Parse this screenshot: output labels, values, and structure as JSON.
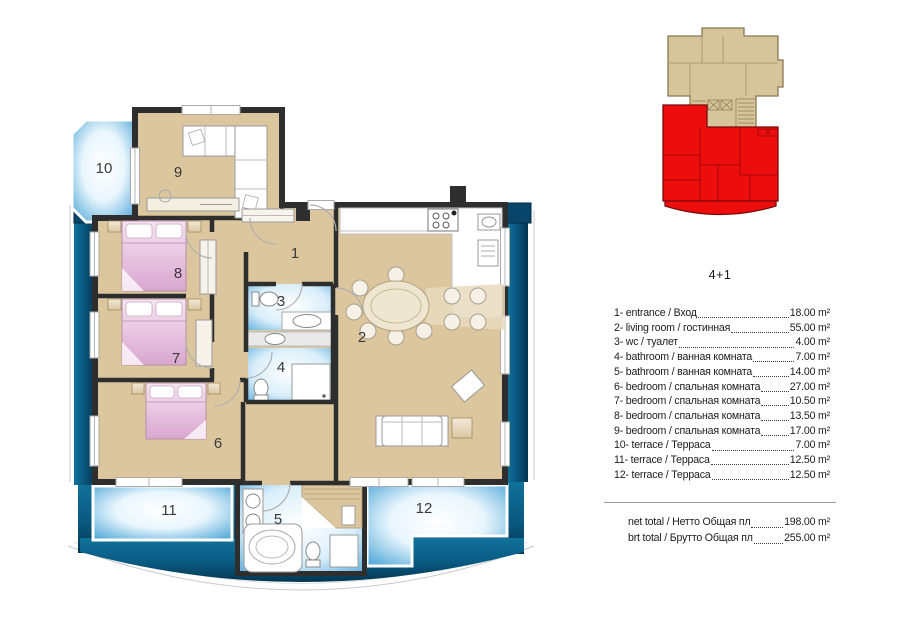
{
  "title": "4+1",
  "legend": {
    "items": [
      {
        "label": "1- entrance / Вход",
        "area": "18.00 m²"
      },
      {
        "label": "2- living room / гостинная",
        "area": "55.00 m²"
      },
      {
        "label": "3- wc / туалет",
        "area": "4.00 m²"
      },
      {
        "label": "4- bathroom / ванная комната",
        "area": "7.00 m²"
      },
      {
        "label": "5- bathroom / ванная комната",
        "area": "14.00 m²"
      },
      {
        "label": "6- bedroom / спальная комната",
        "area": "27.00 m²"
      },
      {
        "label": "7- bedroom / спальная комната",
        "area": "10.50 m²"
      },
      {
        "label": "8- bedroom / спальная комната",
        "area": "13.50 m²"
      },
      {
        "label": "9- bedroom / спальная комната",
        "area": "17.00 m²"
      },
      {
        "label": "10- terrace / Терраса",
        "area": "7.00 m²"
      },
      {
        "label": "11- terrace / Терраса",
        "area": "12.50 m²"
      },
      {
        "label": "12- terrace / Терраса",
        "area": "12.50 m²"
      }
    ],
    "totals": [
      {
        "label": "net total / Нетто Общая пл",
        "area": "198.00 m²"
      },
      {
        "label": "brt total / Брутто Общая пл",
        "area": "255.00 m²"
      }
    ]
  },
  "plan": {
    "room_numbers": [
      "1",
      "2",
      "3",
      "4",
      "5",
      "6",
      "7",
      "8",
      "9",
      "10",
      "11",
      "12"
    ]
  },
  "colors": {
    "wall": "#2e2e2e",
    "room_fill": "#dcc69e",
    "terrace_blue": "#3f9fd4",
    "bath_blue": "#5aabdc",
    "frame_teal": "#0a5a82",
    "bed_pink": "#dfadd3",
    "minimap_beige": "#d6c49a",
    "minimap_red": "#ed0d0d"
  }
}
